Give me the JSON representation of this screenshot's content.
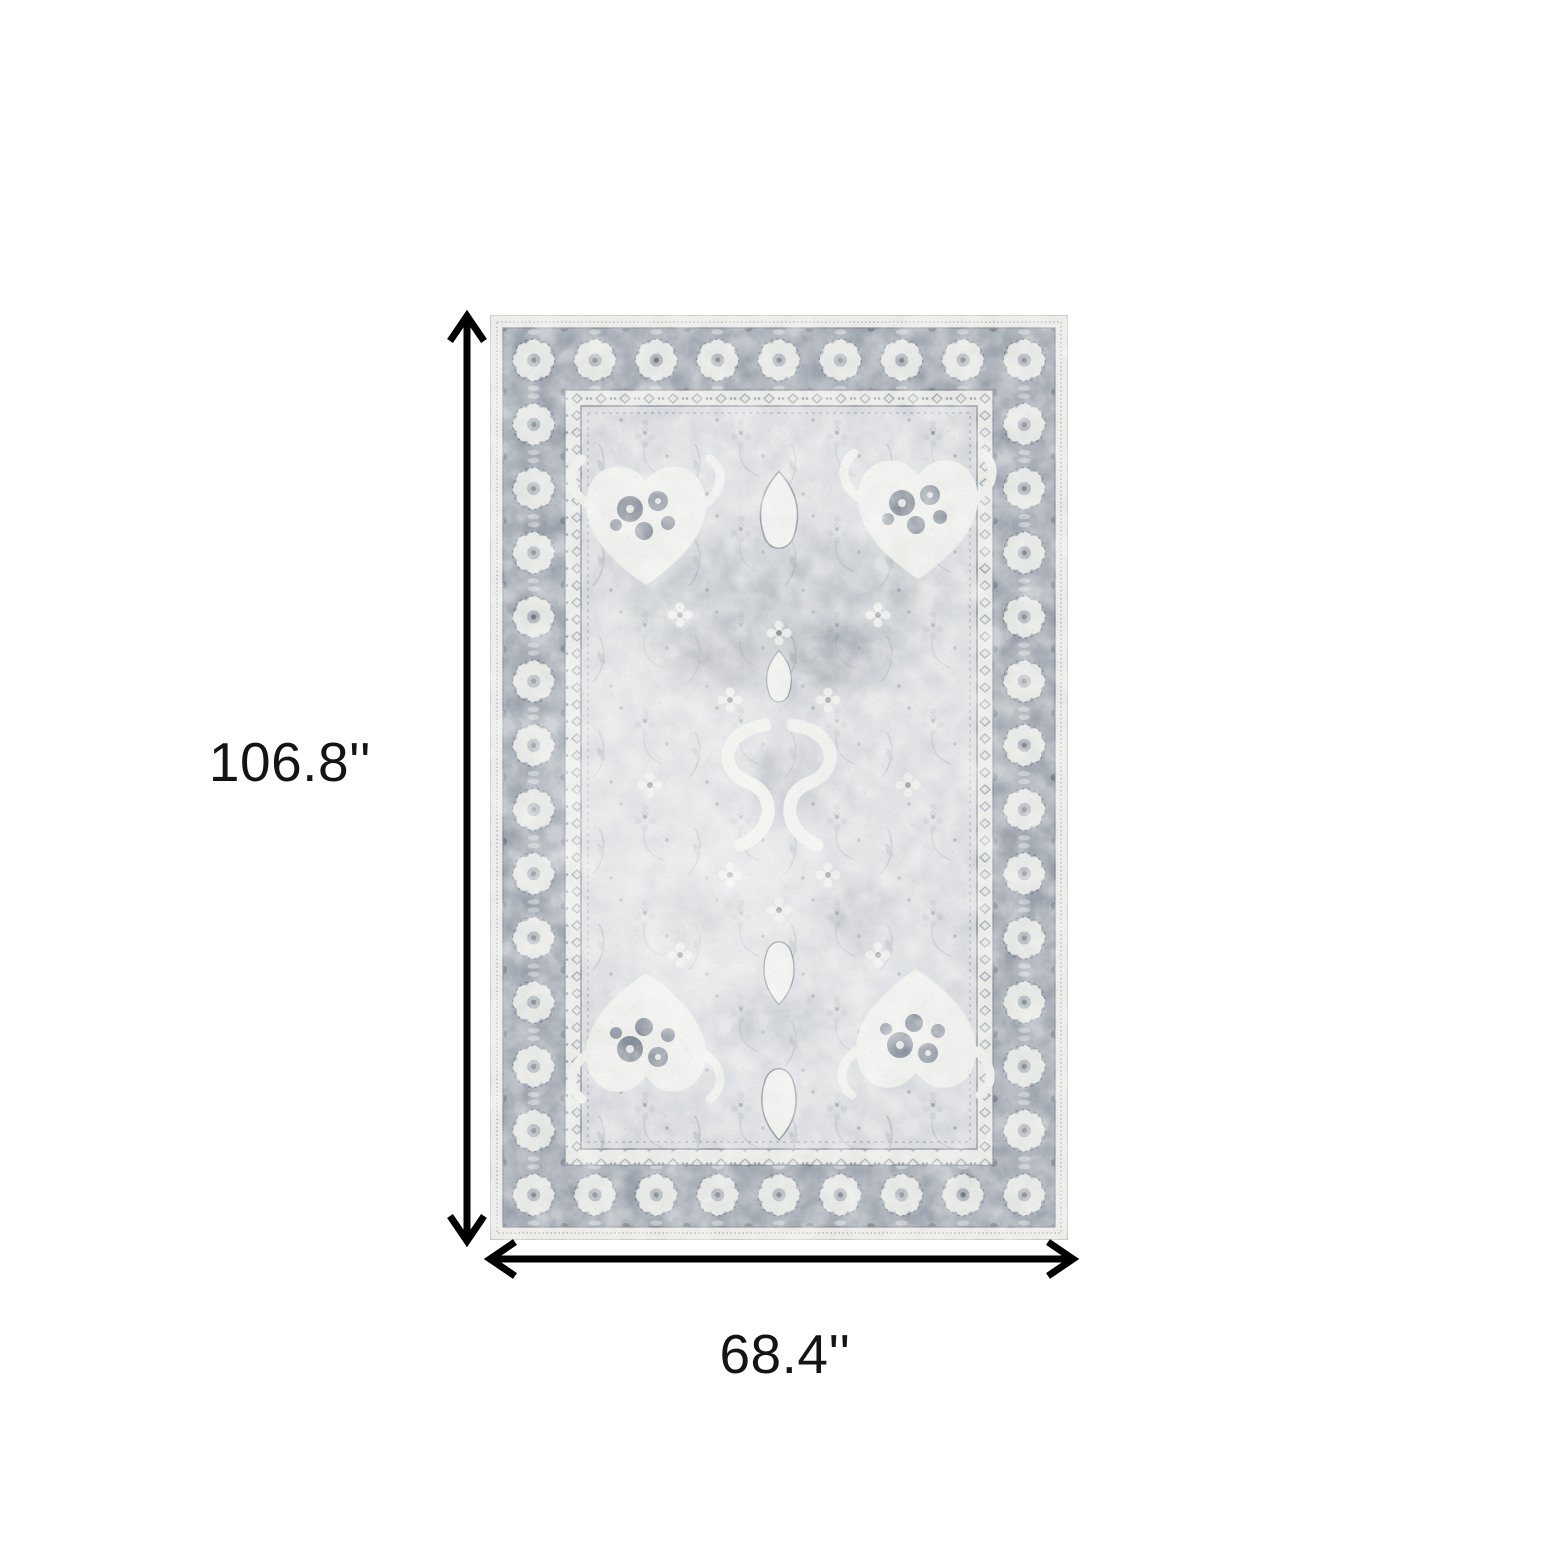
{
  "diagram": {
    "height_label": "106.8''",
    "width_label": "68.4''",
    "arrow_color": "#000000",
    "label_color": "#141414",
    "background_color": "#ffffff"
  },
  "rug": {
    "name": "gray-distressed-oriental-area-rug",
    "colors": {
      "outer_edge": "#eae9e5",
      "border_background": "#9aa1ab",
      "border_motif": "#e2e4e1",
      "guard_band": "#e7e7e4",
      "field": "#d3d6da",
      "field_motif": "#ebece8",
      "dark_accent": "#78808d"
    }
  }
}
